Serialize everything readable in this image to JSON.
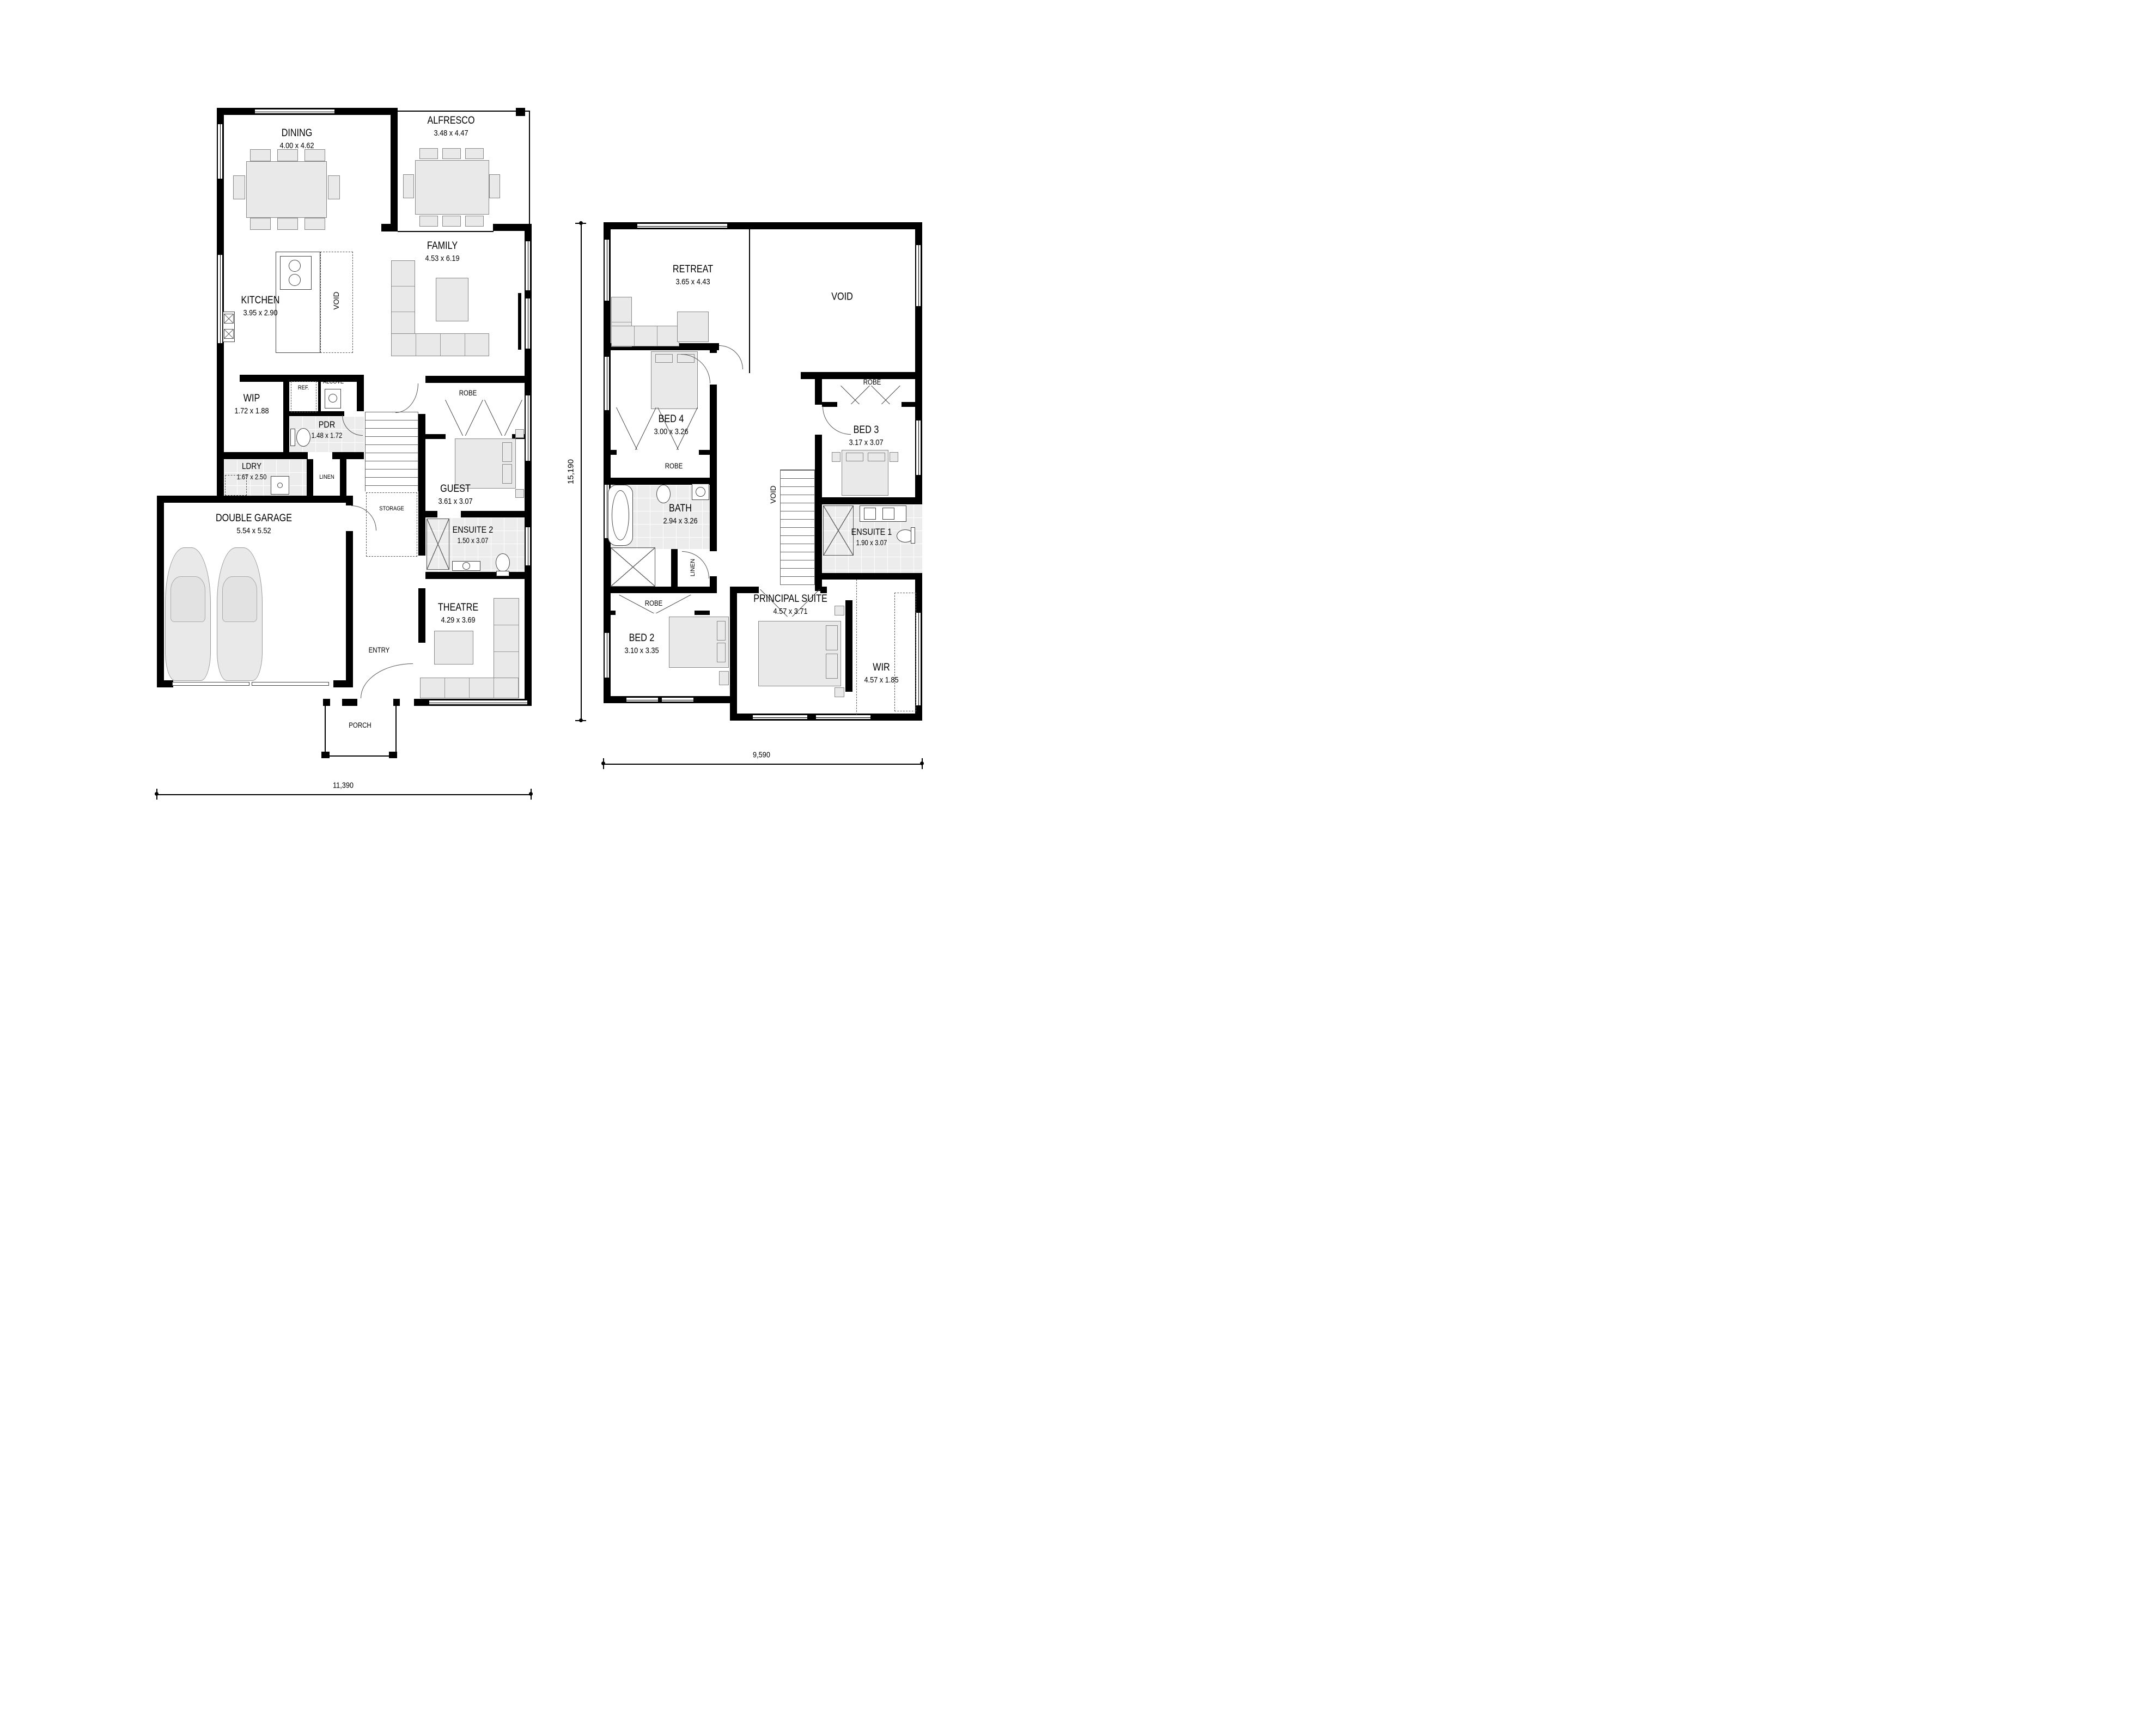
{
  "ground": {
    "rooms": {
      "dining": {
        "name": "DINING",
        "size": "4.00 x 4.62"
      },
      "alfresco": {
        "name": "ALFRESCO",
        "size": "3.48 x 4.47"
      },
      "family": {
        "name": "FAMILY",
        "size": "4.53 x 6.19"
      },
      "kitchen": {
        "name": "KITCHEN",
        "size": "3.95 x 2.90"
      },
      "wip": {
        "name": "WIP",
        "size": "1.72 x 1.88"
      },
      "pdr": {
        "name": "PDR",
        "size": "1.48 x 1.72"
      },
      "ldry": {
        "name": "LDRY",
        "size": "1.67 x 2.50"
      },
      "garage": {
        "name": "DOUBLE GARAGE",
        "size": "5.54 x 5.52"
      },
      "guest": {
        "name": "GUEST",
        "size": "3.61 x 3.07"
      },
      "ensuite2": {
        "name": "ENSUITE 2",
        "size": "1.50 x 3.07"
      },
      "theatre": {
        "name": "THEATRE",
        "size": "4.29 x 3.69"
      }
    },
    "labels": {
      "ref": "REF.",
      "alcove": "ALCOVE",
      "robe": "ROBE",
      "linen": "LINEN",
      "storage": "STORAGE",
      "island_void": "VOID",
      "entry": "ENTRY",
      "porch": "PORCH"
    },
    "dim_width": "11,390"
  },
  "first": {
    "rooms": {
      "retreat": {
        "name": "RETREAT",
        "size": "3.65 x 4.43"
      },
      "bed4": {
        "name": "BED 4",
        "size": "3.00 x 3.26"
      },
      "bed3": {
        "name": "BED 3",
        "size": "3.17 x 3.07"
      },
      "bed2": {
        "name": "BED 2",
        "size": "3.10 x 3.35"
      },
      "bath": {
        "name": "BATH",
        "size": "2.94 x 3.26"
      },
      "ensuite1": {
        "name": "ENSUITE 1",
        "size": "1.90 x 3.07"
      },
      "principal": {
        "name": "PRINCIPAL SUITE",
        "size": "4.57 x 3.71"
      },
      "wir": {
        "name": "WIR",
        "size": "4.57 x 1.85"
      }
    },
    "labels": {
      "void": "VOID",
      "stair_void": "VOID",
      "robe_bed4": "ROBE",
      "robe_bed3": "ROBE",
      "robe_bed2": "ROBE",
      "linen": "LINEN"
    },
    "dim_width": "9,590",
    "dim_height": "15,190"
  }
}
